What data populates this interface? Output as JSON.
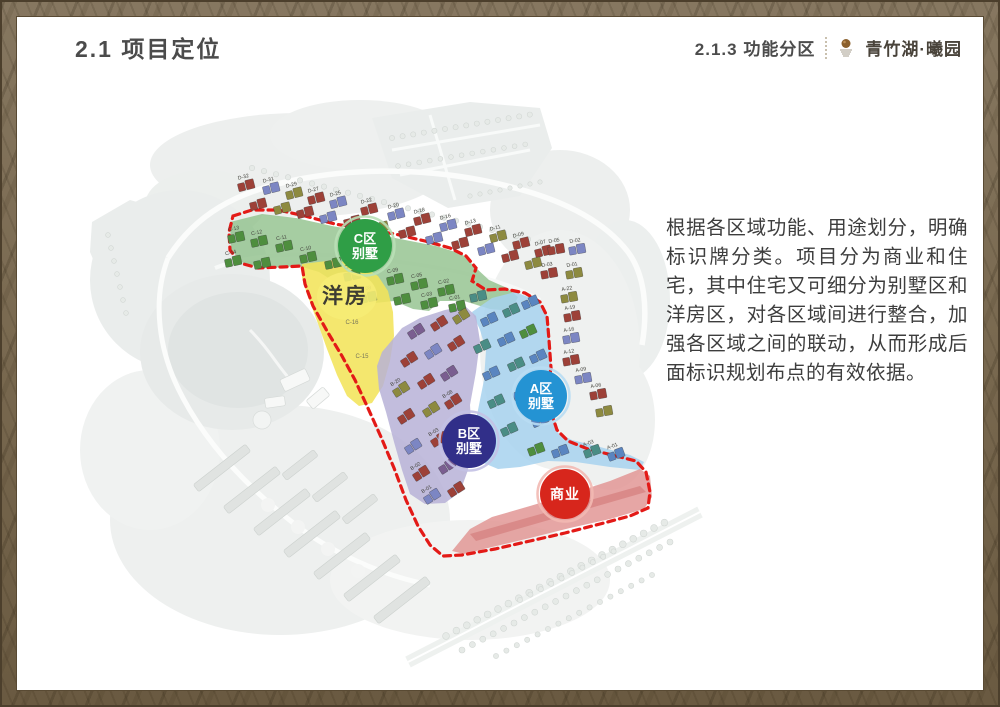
{
  "header": {
    "title": "2.1 项目定位",
    "section": "2.1.3 功能分区",
    "brand": "青竹湖·曦园"
  },
  "description": {
    "text": "根据各区域功能、用途划分，明确标识牌分类。项目分为商业和住宅，其中住宅又可细分为别墅区和洋房区，对各区域间进行整合，加强各区域之间的联动，从而形成后面标识规划布点的有效依据。"
  },
  "map": {
    "areas": [
      {
        "id": "c-band",
        "name": "C区别墅区域",
        "points": "230,222 262,214 296,218 332,226 366,232 400,239 436,246 462,254 475,267 489,280 507,288 518,297 511,311 490,309 464,301 440,301 429,311 413,309 394,301 375,303 361,309 351,300 339,285 319,272 299,266 269,268 244,264 231,250",
        "fill": "#92c28e",
        "opacity": 0.82
      },
      {
        "id": "yangfang",
        "name": "洋房区域",
        "points": "302,264 335,260 362,266 378,276 388,291 393,312 394,336 390,361 383,386 372,403 359,406 347,396 337,375 327,349 317,321 307,294 302,278",
        "fill": "#f2e45a",
        "opacity": 0.88
      },
      {
        "id": "a-zone",
        "name": "A区别墅区域",
        "points": "472,312 492,298 515,292 538,301 548,317 550,346 552,376 548,398 552,418 558,433 572,440 600,447 630,455 644,462 640,470 610,467 576,462 548,461 520,467 498,469 479,461 472,440 478,410 484,380 486,350 480,330",
        "fill": "#a7d2ee",
        "opacity": 0.85
      },
      {
        "id": "b-zone",
        "name": "B区别墅区域",
        "points": "388,345 402,328 420,318 445,310 465,306 476,316 480,341 476,372 470,405 472,438 468,470 460,492 445,503 425,504 410,494 402,470 394,442 386,412 379,389 377,366 382,352",
        "fill": "#b7b1d7",
        "opacity": 0.85
      },
      {
        "id": "commercial",
        "name": "商业区域",
        "points": "452,551 470,529 492,517 530,506 570,494 610,481 640,469 650,476 652,497 644,509 610,519 570,528 530,538 492,547 464,554",
        "fill": "#e29795",
        "opacity": 0.85
      },
      {
        "id": "commercial-stripe",
        "name": "商业内部条带",
        "points": "470,534 640,486 646,492 476,541",
        "fill": "#d47f7e",
        "opacity": 0.7
      }
    ],
    "boundary": {
      "color": "#e31a17",
      "width": 3.2,
      "dash": "7 5",
      "points": "233,216 252,210 278,210 305,216 335,224 365,229 395,234 425,241 450,248 466,256 476,268 472,281 486,290 505,289 525,293 540,302 547,316 549,340 551,368 547,390 551,412 557,430 568,441 588,449 612,455 636,461 646,472 650,492 648,508 630,516 600,524 565,533 530,541 495,549 462,555 443,556 430,545 418,526 406,500 394,468 381,437 367,406 355,380 342,356 327,331 313,306 305,284 302,266 282,267 258,268 240,263 230,250 229,232"
    },
    "zone_badges": [
      {
        "id": "c-villa",
        "cx": 365,
        "cy": 246,
        "r": 27,
        "fill": "#2f9e46",
        "ring": "#b9e0b6",
        "lines": [
          "C区",
          "别墅"
        ]
      },
      {
        "id": "a-villa",
        "cx": 541,
        "cy": 396,
        "r": 26,
        "fill": "#2493d3",
        "ring": "#b8ddf3",
        "lines": [
          "A区",
          "别墅"
        ]
      },
      {
        "id": "b-villa",
        "cx": 469,
        "cy": 441,
        "r": 27,
        "fill": "#312f89",
        "ring": "#c3c1e4",
        "lines": [
          "B区",
          "别墅"
        ]
      },
      {
        "id": "commercial",
        "cx": 565,
        "cy": 494,
        "r": 25,
        "fill": "#d7261c",
        "ring": "#f2b9b2",
        "lines": [
          "商业"
        ]
      }
    ],
    "text_labels": [
      {
        "id": "yangfang-label",
        "x": 345,
        "y": 303,
        "text": "洋房",
        "size": 21,
        "color": "#3e3d33",
        "weight": "bold",
        "ls": 2,
        "halo": true
      },
      {
        "id": "lot-c16",
        "x": 352,
        "y": 324,
        "text": "C-16",
        "size": 6,
        "color": "#77765a"
      },
      {
        "id": "lot-c15",
        "x": 362,
        "y": 358,
        "text": "C-15",
        "size": 6,
        "color": "#77765a"
      }
    ],
    "house_colors": {
      "red": "#9d4138",
      "blue": "#7c86c3",
      "olive": "#8d8a40",
      "green": "#4e8e3e",
      "teal": "#4a8d85",
      "purple": "#7a5e90",
      "blue2": "#5a85c0"
    },
    "houses": [
      {
        "x": 246,
        "y": 186,
        "c": "red",
        "rot": -14,
        "label": "D-32"
      },
      {
        "x": 271,
        "y": 189,
        "c": "blue",
        "rot": -14,
        "label": "D-31"
      },
      {
        "x": 294,
        "y": 194,
        "c": "olive",
        "rot": -14,
        "label": "D-29"
      },
      {
        "x": 316,
        "y": 199,
        "c": "red",
        "rot": -14,
        "label": "D-27"
      },
      {
        "x": 338,
        "y": 203,
        "c": "blue",
        "rot": -14,
        "label": "D-25"
      },
      {
        "x": 369,
        "y": 210,
        "c": "red",
        "rot": -14,
        "label": "D-22"
      },
      {
        "x": 396,
        "y": 215,
        "c": "blue",
        "rot": -14,
        "label": "D-20"
      },
      {
        "x": 422,
        "y": 220,
        "c": "red",
        "rot": -14,
        "label": "D-18"
      },
      {
        "x": 448,
        "y": 226,
        "c": "blue",
        "rot": -14,
        "label": "D-16"
      },
      {
        "x": 473,
        "y": 231,
        "c": "red",
        "rot": -14,
        "label": "D-13"
      },
      {
        "x": 498,
        "y": 237,
        "c": "olive",
        "rot": -14,
        "label": "D-11"
      },
      {
        "x": 521,
        "y": 244,
        "c": "red",
        "rot": -14,
        "label": "D-09"
      },
      {
        "x": 543,
        "y": 252,
        "c": "red",
        "rot": -14,
        "label": "D-07"
      },
      {
        "x": 258,
        "y": 205,
        "c": "red",
        "rot": -14
      },
      {
        "x": 282,
        "y": 209,
        "c": "olive",
        "rot": -14
      },
      {
        "x": 305,
        "y": 213,
        "c": "red",
        "rot": -14
      },
      {
        "x": 328,
        "y": 218,
        "c": "blue",
        "rot": -14
      },
      {
        "x": 352,
        "y": 222,
        "c": "red",
        "rot": -14
      },
      {
        "x": 380,
        "y": 228,
        "c": "olive",
        "rot": -14
      },
      {
        "x": 407,
        "y": 233,
        "c": "red",
        "rot": -14
      },
      {
        "x": 434,
        "y": 239,
        "c": "blue",
        "rot": -14
      },
      {
        "x": 460,
        "y": 244,
        "c": "red",
        "rot": -14
      },
      {
        "x": 486,
        "y": 250,
        "c": "blue",
        "rot": -14
      },
      {
        "x": 510,
        "y": 257,
        "c": "red",
        "rot": -14
      },
      {
        "x": 533,
        "y": 264,
        "c": "olive",
        "rot": -14
      },
      {
        "x": 556,
        "y": 250,
        "c": "red",
        "rot": -10,
        "label": "D-05"
      },
      {
        "x": 577,
        "y": 250,
        "c": "blue",
        "rot": -10,
        "label": "D-02"
      },
      {
        "x": 549,
        "y": 274,
        "c": "red",
        "rot": -10,
        "label": "D-03"
      },
      {
        "x": 574,
        "y": 274,
        "c": "olive",
        "rot": -10,
        "label": "D-01"
      },
      {
        "x": 569,
        "y": 298,
        "c": "olive",
        "rot": -10,
        "label": "A-22"
      },
      {
        "x": 572,
        "y": 317,
        "c": "red",
        "rot": -10,
        "label": "A-19"
      },
      {
        "x": 571,
        "y": 339,
        "c": "blue",
        "rot": -10,
        "label": "A-16"
      },
      {
        "x": 571,
        "y": 361,
        "c": "red",
        "rot": -10,
        "label": "A-12"
      },
      {
        "x": 583,
        "y": 379,
        "c": "blue",
        "rot": -10,
        "label": "A-09"
      },
      {
        "x": 598,
        "y": 395,
        "c": "red",
        "rot": -10,
        "label": "A-06"
      },
      {
        "x": 604,
        "y": 412,
        "c": "olive",
        "rot": -10
      },
      {
        "x": 236,
        "y": 238,
        "c": "green",
        "rot": -12,
        "label": "C-13"
      },
      {
        "x": 259,
        "y": 242,
        "c": "green",
        "rot": -12,
        "label": "C-12"
      },
      {
        "x": 284,
        "y": 247,
        "c": "green",
        "rot": -12,
        "label": "C-11"
      },
      {
        "x": 233,
        "y": 262,
        "c": "green",
        "rot": -12,
        "label": "C-14"
      },
      {
        "x": 262,
        "y": 264,
        "c": "green",
        "rot": -12
      },
      {
        "x": 308,
        "y": 258,
        "c": "green",
        "rot": -12,
        "label": "C-10"
      },
      {
        "x": 333,
        "y": 264,
        "c": "green",
        "rot": -12
      },
      {
        "x": 352,
        "y": 276,
        "c": "green",
        "rot": -12,
        "label": "C-07"
      },
      {
        "x": 368,
        "y": 298,
        "c": "green",
        "rot": -12,
        "label": "C-08"
      },
      {
        "x": 395,
        "y": 280,
        "c": "green",
        "rot": -12,
        "label": "C-09"
      },
      {
        "x": 402,
        "y": 300,
        "c": "green",
        "rot": -12
      },
      {
        "x": 419,
        "y": 285,
        "c": "green",
        "rot": -12,
        "label": "C-05"
      },
      {
        "x": 429,
        "y": 304,
        "c": "green",
        "rot": -12,
        "label": "C-03"
      },
      {
        "x": 446,
        "y": 291,
        "c": "green",
        "rot": -12,
        "label": "C-02"
      },
      {
        "x": 457,
        "y": 307,
        "c": "green",
        "rot": -12,
        "label": "C-01"
      },
      {
        "x": 478,
        "y": 297,
        "c": "teal",
        "rot": -12
      },
      {
        "x": 489,
        "y": 320,
        "c": "blue2",
        "rot": -24
      },
      {
        "x": 511,
        "y": 311,
        "c": "teal",
        "rot": -24
      },
      {
        "x": 530,
        "y": 303,
        "c": "blue2",
        "rot": -24
      },
      {
        "x": 482,
        "y": 347,
        "c": "teal",
        "rot": -24
      },
      {
        "x": 506,
        "y": 340,
        "c": "blue2",
        "rot": -24
      },
      {
        "x": 528,
        "y": 332,
        "c": "green",
        "rot": -24
      },
      {
        "x": 491,
        "y": 374,
        "c": "blue2",
        "rot": -24
      },
      {
        "x": 516,
        "y": 365,
        "c": "teal",
        "rot": -24
      },
      {
        "x": 538,
        "y": 357,
        "c": "blue2",
        "rot": -24
      },
      {
        "x": 496,
        "y": 402,
        "c": "teal",
        "rot": -24
      },
      {
        "x": 521,
        "y": 394,
        "c": "blue2",
        "rot": -24
      },
      {
        "x": 540,
        "y": 421,
        "c": "blue2",
        "rot": -24
      },
      {
        "x": 509,
        "y": 430,
        "c": "teal",
        "rot": -24
      },
      {
        "x": 536,
        "y": 450,
        "c": "green",
        "rot": -20
      },
      {
        "x": 560,
        "y": 452,
        "c": "blue2",
        "rot": -20
      },
      {
        "x": 592,
        "y": 452,
        "c": "teal",
        "rot": -20,
        "label": "A-03"
      },
      {
        "x": 616,
        "y": 455,
        "c": "blue2",
        "rot": -20,
        "label": "A-01"
      },
      {
        "x": 416,
        "y": 332,
        "c": "purple",
        "rot": -32
      },
      {
        "x": 439,
        "y": 324,
        "c": "red",
        "rot": -32
      },
      {
        "x": 461,
        "y": 317,
        "c": "olive",
        "rot": -32
      },
      {
        "x": 409,
        "y": 360,
        "c": "red",
        "rot": -32
      },
      {
        "x": 433,
        "y": 352,
        "c": "blue",
        "rot": -32
      },
      {
        "x": 456,
        "y": 344,
        "c": "red",
        "rot": -32
      },
      {
        "x": 401,
        "y": 390,
        "c": "olive",
        "rot": -32,
        "label": "B-20"
      },
      {
        "x": 426,
        "y": 382,
        "c": "red",
        "rot": -32
      },
      {
        "x": 449,
        "y": 374,
        "c": "purple",
        "rot": -32
      },
      {
        "x": 406,
        "y": 417,
        "c": "red",
        "rot": -32
      },
      {
        "x": 431,
        "y": 410,
        "c": "olive",
        "rot": -32
      },
      {
        "x": 453,
        "y": 402,
        "c": "red",
        "rot": -32,
        "label": "B-08"
      },
      {
        "x": 413,
        "y": 447,
        "c": "blue",
        "rot": -32
      },
      {
        "x": 439,
        "y": 440,
        "c": "red",
        "rot": -32,
        "label": "B-03"
      },
      {
        "x": 421,
        "y": 474,
        "c": "red",
        "rot": -32,
        "label": "B-02"
      },
      {
        "x": 447,
        "y": 467,
        "c": "purple",
        "rot": -32
      },
      {
        "x": 432,
        "y": 497,
        "c": "blue",
        "rot": -32,
        "label": "B-01"
      },
      {
        "x": 456,
        "y": 490,
        "c": "red",
        "rot": -32
      }
    ]
  }
}
